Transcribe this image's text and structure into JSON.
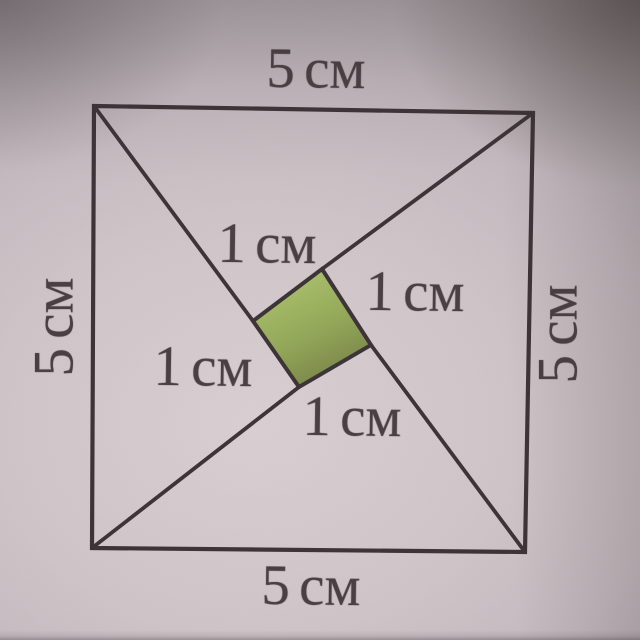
{
  "page": {
    "description": "Photograph of a textbook geometry figure: a square with side 5 cm, four segments drawn from its corners, and a shaded green square with side 1 cm in the centre"
  },
  "figure": {
    "unit": "см",
    "outer_side_labels": {
      "top": "5 см",
      "bottom": "5 см",
      "left": "5 см",
      "right": "5 см"
    },
    "inner_side_labels": {
      "top_left": "1 см",
      "right": "1 см",
      "left": "1 см",
      "bottom": "1 см"
    },
    "colors": {
      "line": "#3a3135",
      "text": "#473d40",
      "inner_fill_light": "#adc56d",
      "inner_fill_mid": "#93a757",
      "inner_fill_dark": "#6f7b41",
      "paper_light": "#d9cfd2",
      "paper_dark": "#7f777d"
    },
    "geometry": {
      "outer_square": [
        [
          94,
          106
        ],
        [
          533,
          113
        ],
        [
          525,
          552
        ],
        [
          92,
          548
        ]
      ],
      "inner_square": [
        [
          322,
          269
        ],
        [
          371,
          345
        ],
        [
          299,
          387
        ],
        [
          253,
          321
        ]
      ],
      "corner_segments": [
        [
          [
            94,
            106
          ],
          [
            253,
            321
          ]
        ],
        [
          [
            533,
            113
          ],
          [
            322,
            269
          ]
        ],
        [
          [
            525,
            552
          ],
          [
            371,
            345
          ]
        ],
        [
          [
            92,
            548
          ],
          [
            299,
            387
          ]
        ]
      ]
    }
  }
}
